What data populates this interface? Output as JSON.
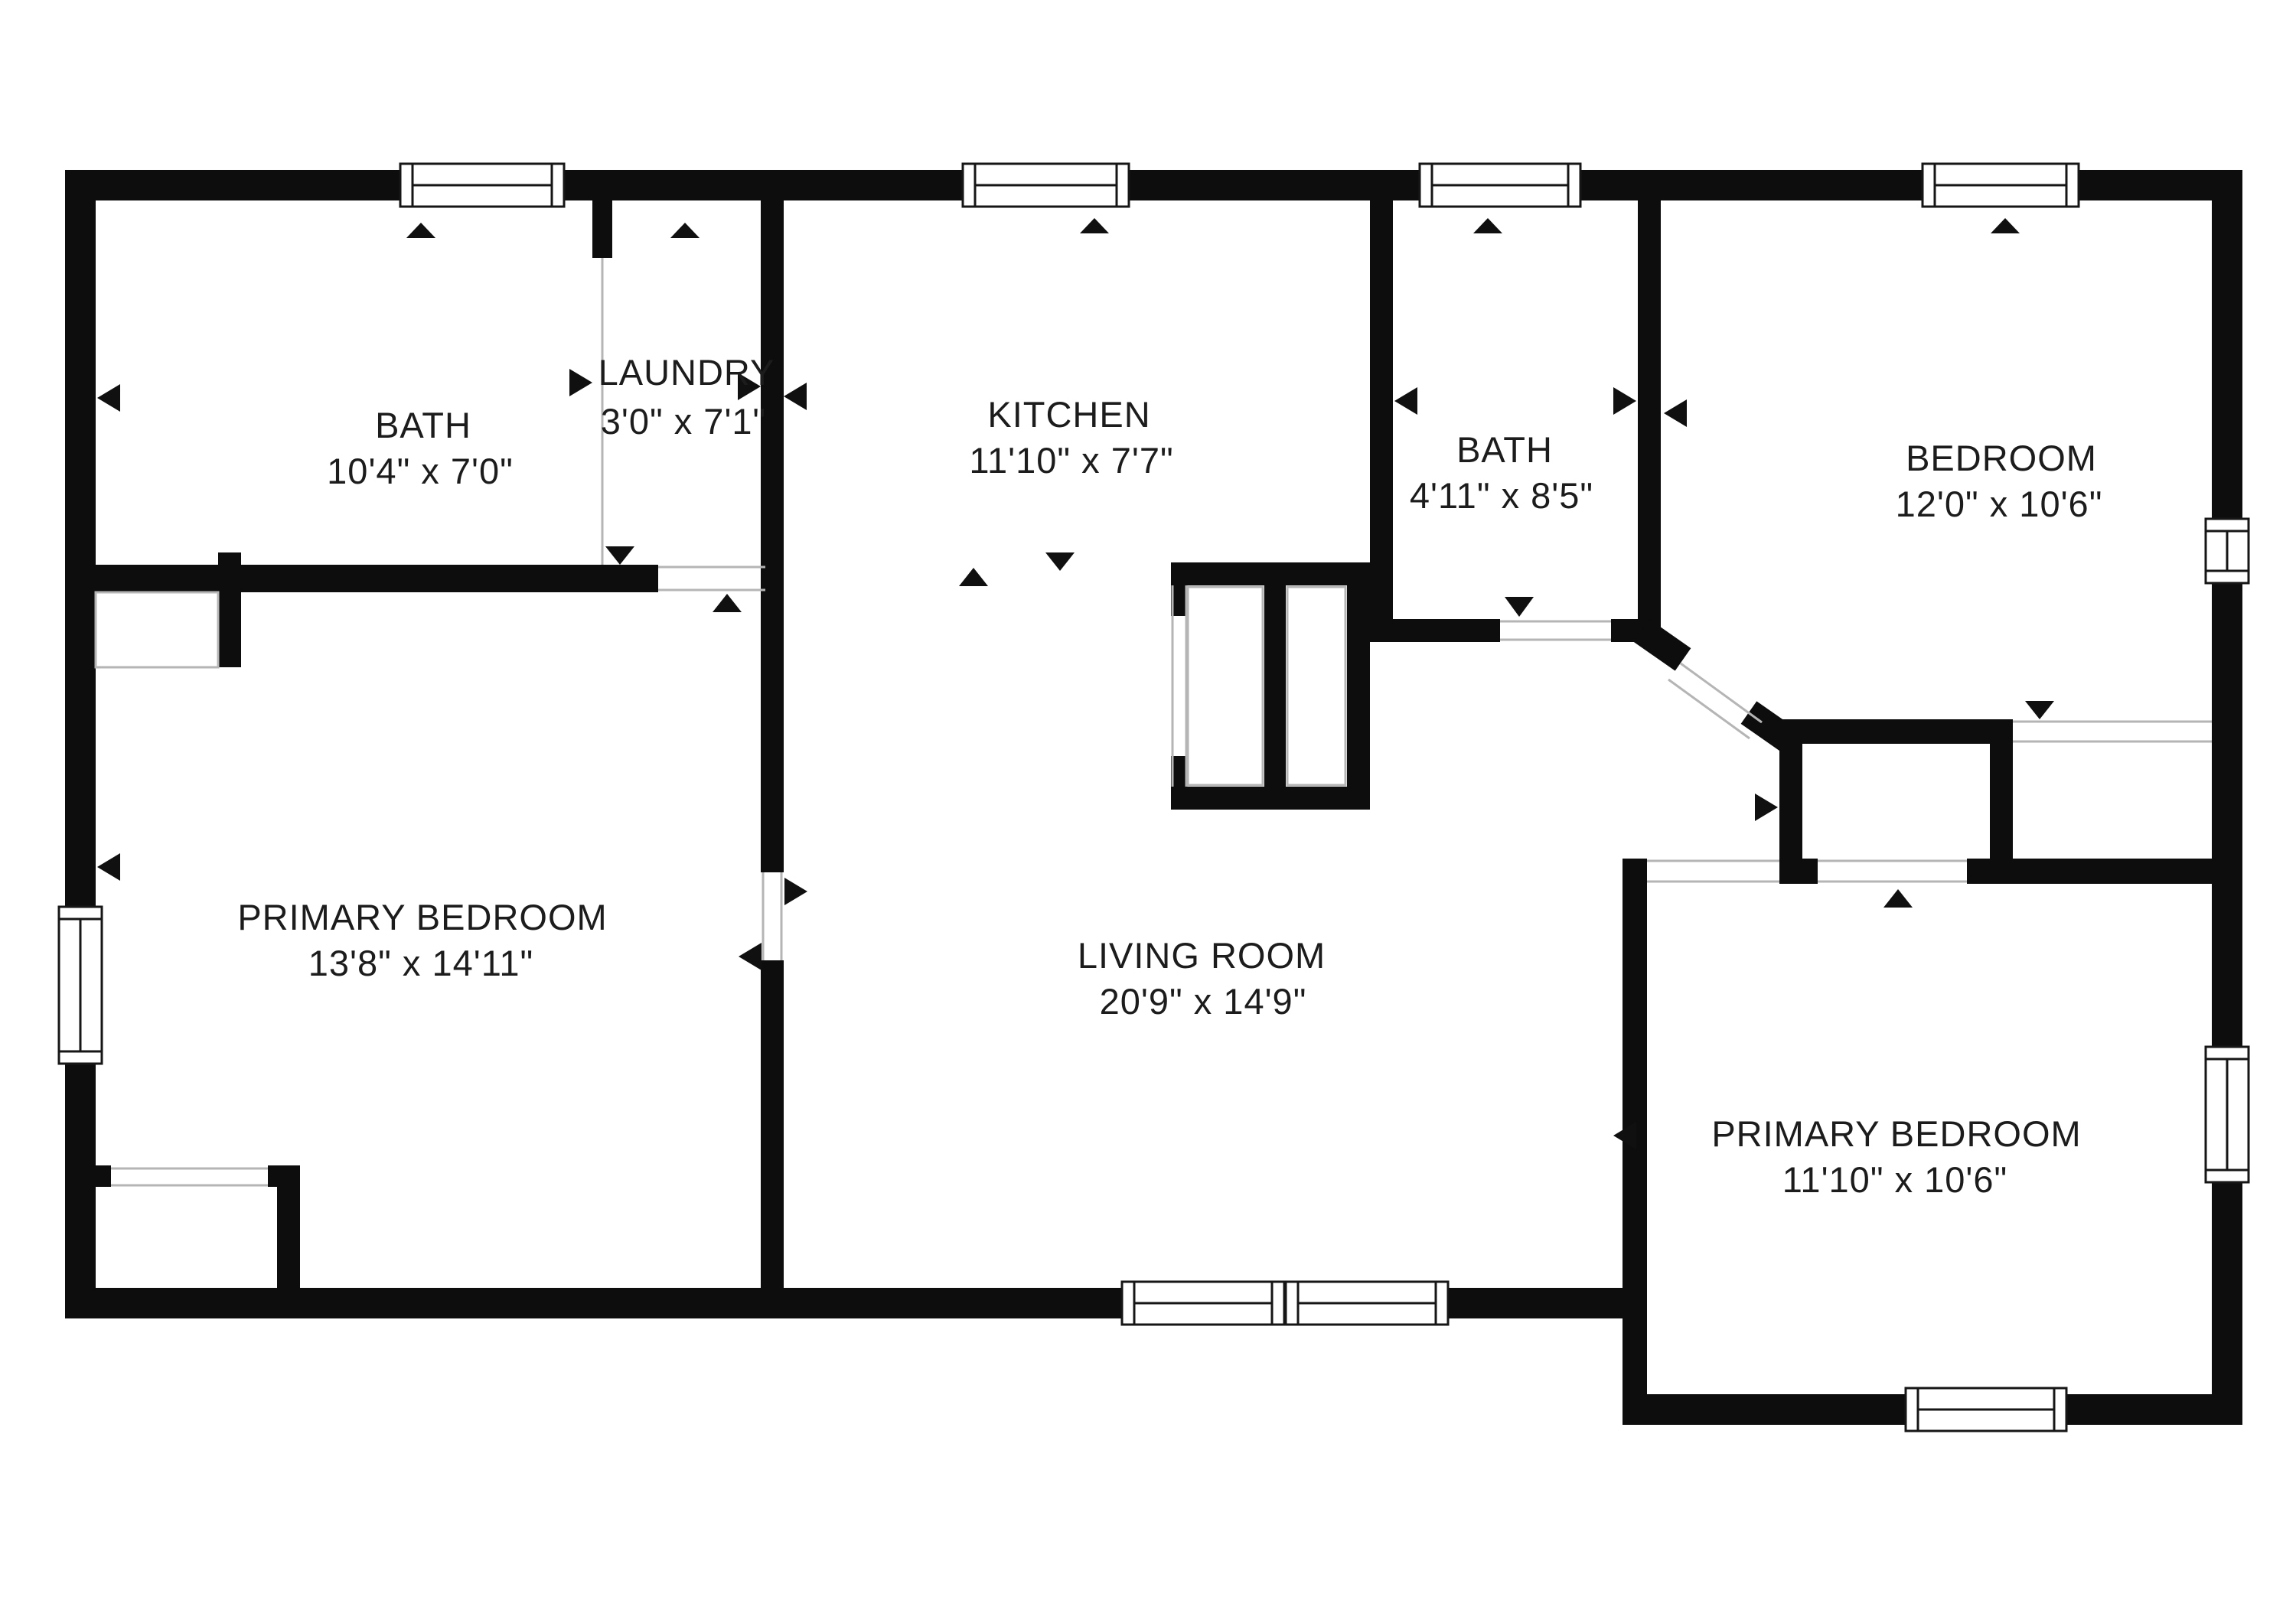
{
  "colors": {
    "wall": "#0d0d0d",
    "background": "#ffffff",
    "opening_line": "#b5b5b5",
    "text": "#1c1c1c"
  },
  "rooms": [
    {
      "id": "bath-upper",
      "name": "BATH",
      "dimensions": "10'4\" x 7'0\""
    },
    {
      "id": "laundry",
      "name": "LAUNDRY",
      "dimensions": "3'0\" x 7'1\""
    },
    {
      "id": "kitchen",
      "name": "KITCHEN",
      "dimensions": "11'10\" x 7'7\""
    },
    {
      "id": "bath-middle",
      "name": "BATH",
      "dimensions": "4'11\" x 8'5\""
    },
    {
      "id": "bedroom",
      "name": "BEDROOM",
      "dimensions": "12'0\" x 10'6\""
    },
    {
      "id": "primary-bedroom-left",
      "name": "PRIMARY BEDROOM",
      "dimensions": "13'8\" x 14'11\""
    },
    {
      "id": "living-room",
      "name": "LIVING ROOM",
      "dimensions": "20'9\" x 14'9\""
    },
    {
      "id": "primary-bedroom-right",
      "name": "PRIMARY BEDROOM",
      "dimensions": "11'10\" x 10'6\""
    }
  ]
}
